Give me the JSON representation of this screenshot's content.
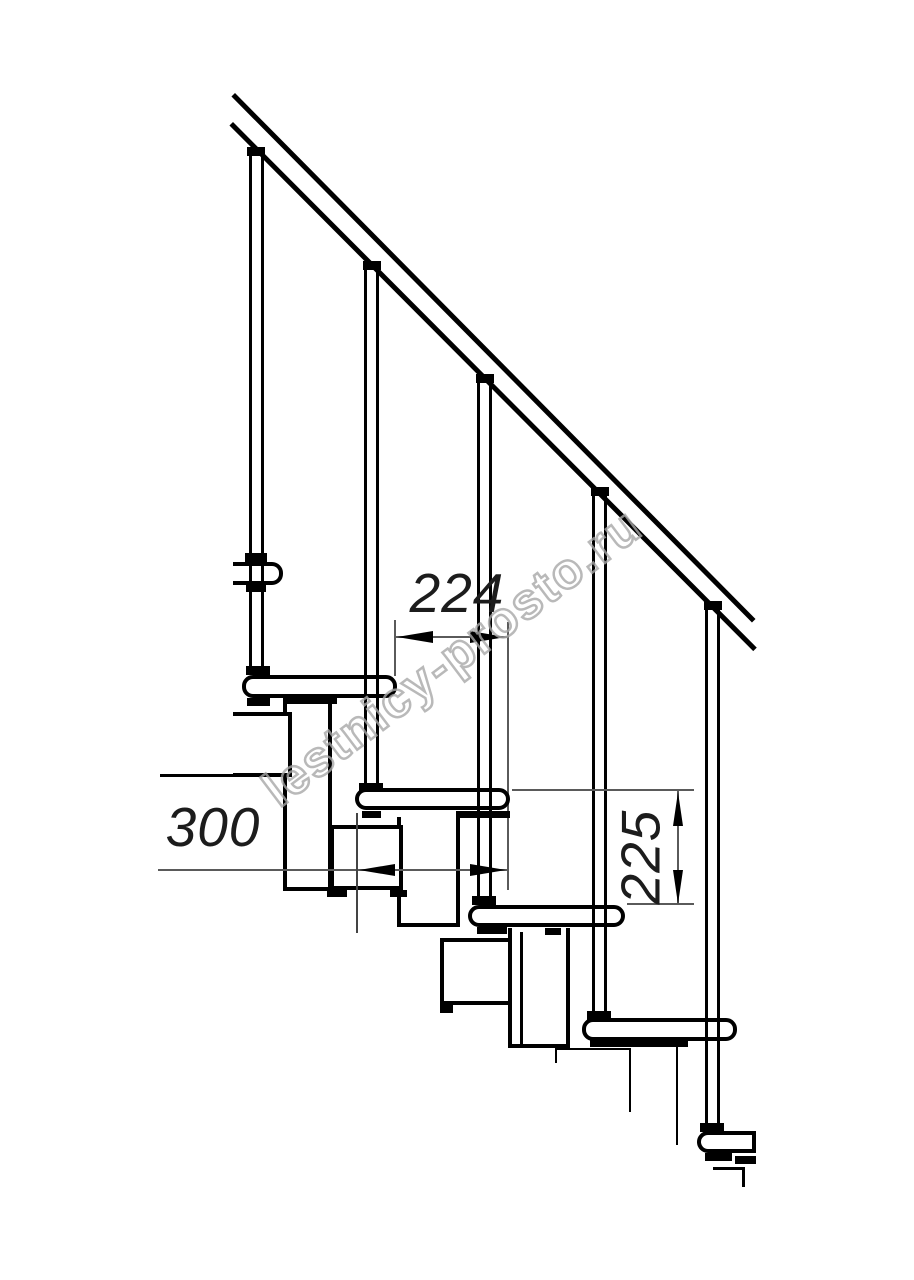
{
  "drawing": {
    "type": "staircase-side-view-technical-drawing",
    "dimensions": {
      "step_run": "224",
      "module_depth": "300",
      "riser_height": "225"
    },
    "watermark": "lestnicy-prosto.ru",
    "colors": {
      "outline": "#000000",
      "dimension_line": "#5a5a5a",
      "watermark": "#a8a8a8",
      "background": "#ffffff"
    }
  }
}
